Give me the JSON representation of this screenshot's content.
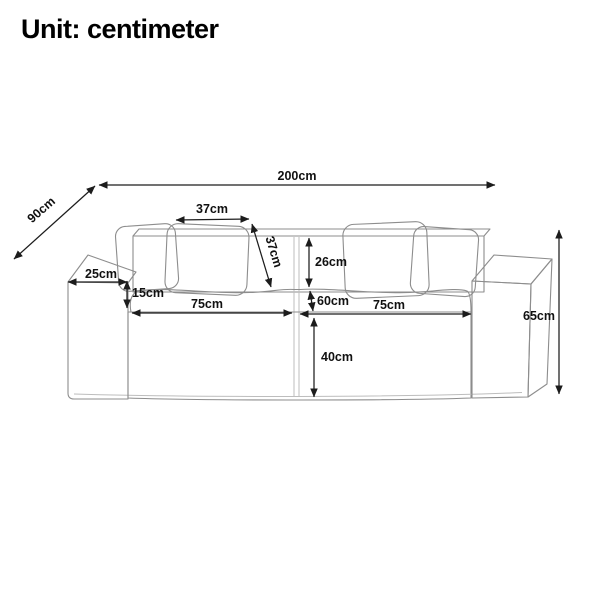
{
  "title": "Unit: centimeter",
  "colors": {
    "background": "#ffffff",
    "dimension_line": "#1c1c1c",
    "label_text": "#111111",
    "sofa_outline": "#8d8d8d",
    "sofa_fill": "#fafaf8",
    "corduroy_texture": "#ebebe6"
  },
  "dimensions": {
    "total_width": {
      "label": "200cm"
    },
    "total_depth": {
      "label": "90cm"
    },
    "pillow_width": {
      "label": "37cm"
    },
    "pillow_height": {
      "label": "37cm"
    },
    "backrest_above_seat": {
      "label": "26cm"
    },
    "armrest_width": {
      "label": "25cm"
    },
    "seat_thickness": {
      "label": "15cm"
    },
    "seat_width_left": {
      "label": "75cm"
    },
    "seat_depth": {
      "label": "60cm"
    },
    "seat_width_right": {
      "label": "75cm"
    },
    "base_height": {
      "label": "40cm"
    },
    "total_height": {
      "label": "65cm"
    }
  }
}
